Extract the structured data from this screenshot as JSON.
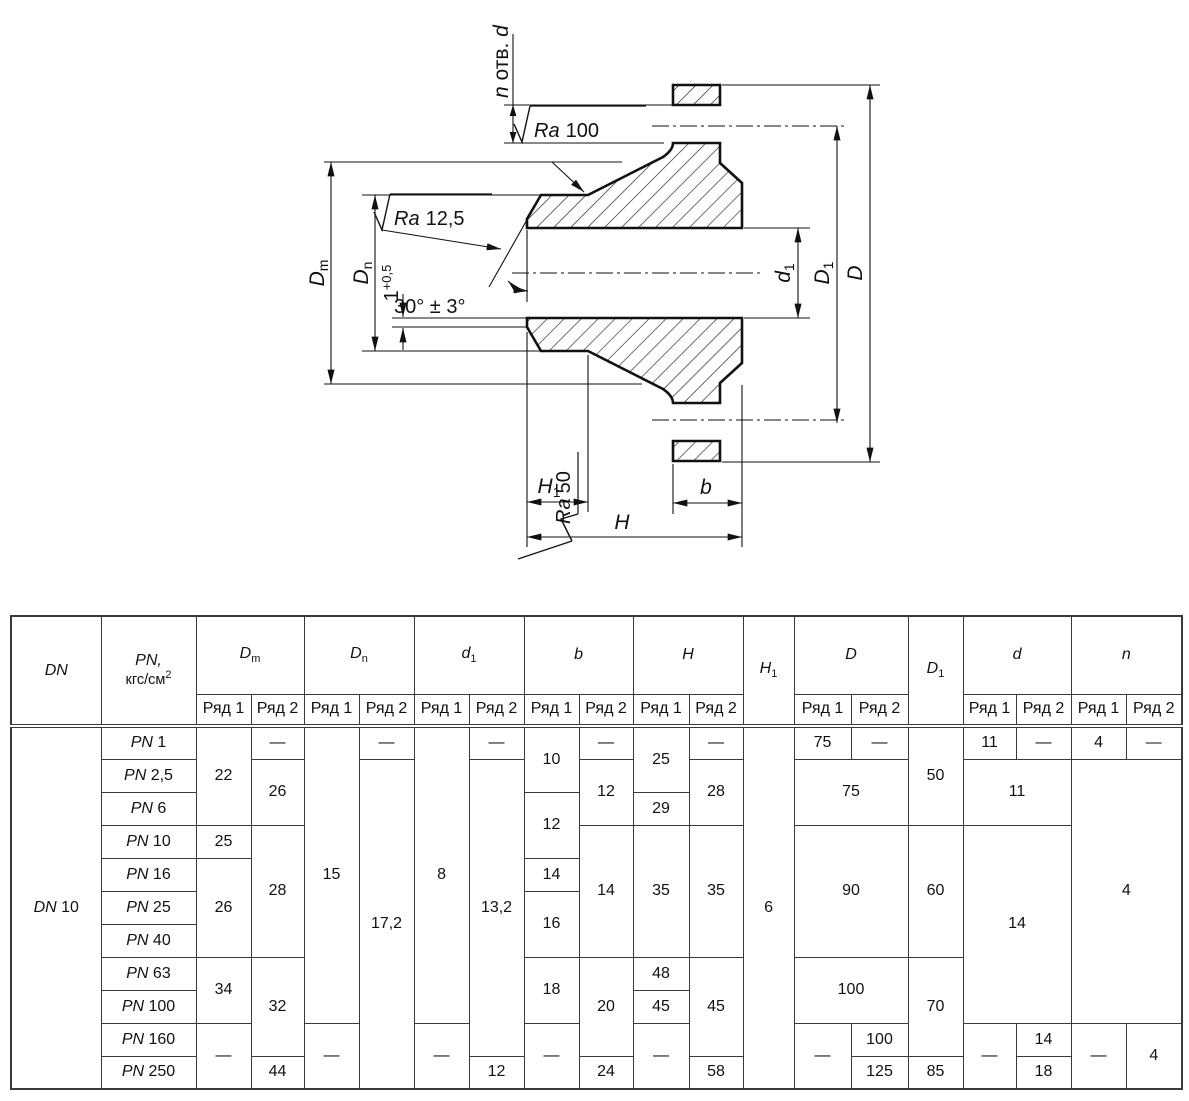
{
  "drawing": {
    "holes_label": {
      "n": "n",
      "mid": " отв. ",
      "d": "d"
    },
    "roughness": {
      "ra100": {
        "ra": "Ra",
        "val": "100"
      },
      "ra125": {
        "ra": "Ra",
        "val": "12,5"
      },
      "ra50": {
        "ra": "Ra",
        "val": "50"
      }
    },
    "angle_note": "30° ± 3°",
    "root_face": {
      "base": "1",
      "sup": "+0,5"
    },
    "dims": {
      "Dm": {
        "base": "D",
        "sub": "m"
      },
      "Dn": {
        "base": "D",
        "sub": "n"
      },
      "d1": {
        "base": "d",
        "sub": "1"
      },
      "D1": {
        "base": "D",
        "sub": "1"
      },
      "D": {
        "base": "D",
        "sub": ""
      },
      "H1": {
        "base": "H",
        "sub": "1"
      },
      "H": {
        "base": "H",
        "sub": ""
      },
      "b": {
        "base": "b",
        "sub": ""
      }
    }
  },
  "table": {
    "dn_header": "DN",
    "pn_header": {
      "line1": "PN,",
      "line2": "кгс/см",
      "sup": "2"
    },
    "row_label_1": "Ряд 1",
    "row_label_2": "Ряд 2",
    "columns": [
      {
        "key": "Dm",
        "base": "D",
        "sub": "m",
        "split": true
      },
      {
        "key": "Dn",
        "base": "D",
        "sub": "n",
        "split": true
      },
      {
        "key": "d1",
        "base": "d",
        "sub": "1",
        "split": true
      },
      {
        "key": "b",
        "base": "b",
        "sub": "",
        "split": true
      },
      {
        "key": "H",
        "base": "H",
        "sub": "",
        "split": true
      },
      {
        "key": "H1",
        "base": "H",
        "sub": "1",
        "split": false
      },
      {
        "key": "D",
        "base": "D",
        "sub": "",
        "split": true
      },
      {
        "key": "D1",
        "base": "D",
        "sub": "1",
        "split": false
      },
      {
        "key": "d",
        "base": "d",
        "sub": "",
        "split": true
      },
      {
        "key": "n",
        "base": "n",
        "sub": "",
        "split": true
      }
    ],
    "dn_value": {
      "prefix": "DN",
      "value": "10",
      "rowspan": 11
    },
    "pn_prefix": "PN",
    "rows": [
      {
        "pn": "1",
        "cells": [
          [
            "dm-r1",
            "22",
            3,
            1
          ],
          [
            "dm-r2",
            "—",
            1,
            1
          ],
          [
            "dn-r1",
            "15",
            9,
            1
          ],
          [
            "dn-r2",
            "—",
            1,
            1
          ],
          [
            "d1-r1",
            "8",
            9,
            1
          ],
          [
            "d1-r2",
            "—",
            1,
            1
          ],
          [
            "b-r1",
            "10",
            2,
            1
          ],
          [
            "b-r2",
            "—",
            1,
            1
          ],
          [
            "h-r1",
            "25",
            2,
            1
          ],
          [
            "h-r2",
            "—",
            1,
            1
          ],
          [
            "h1-col",
            "6",
            11,
            1
          ],
          [
            "d-col-r1",
            "75",
            1,
            1
          ],
          [
            "d-col-r2",
            "—",
            1,
            1
          ],
          [
            "d1-col",
            "50",
            3,
            1
          ],
          [
            "d-small-r1",
            "11",
            1,
            1
          ],
          [
            "d-small-r2",
            "—",
            1,
            1
          ],
          [
            "n-r1",
            "4",
            1,
            1
          ],
          [
            "n-r2",
            "—",
            1,
            1
          ]
        ]
      },
      {
        "pn": "2,5",
        "cells": [
          [
            "dm-r2",
            "26",
            2,
            1
          ],
          [
            "dn-r2",
            "17,2",
            10,
            1
          ],
          [
            "d1-r2",
            "13,2",
            9,
            1
          ],
          [
            "b-r2",
            "12",
            2,
            1
          ],
          [
            "h-r2",
            "28",
            2,
            1
          ],
          [
            "d-col",
            "75",
            2,
            2
          ],
          [
            "d-small",
            "11",
            2,
            2
          ],
          [
            "n",
            "4",
            8,
            2
          ]
        ]
      },
      {
        "pn": "6",
        "cells": [
          [
            "b-r1",
            "12",
            2,
            1
          ],
          [
            "h-r1",
            "29",
            1,
            1
          ]
        ]
      },
      {
        "pn": "10",
        "cells": [
          [
            "dm-r1",
            "25",
            1,
            1
          ],
          [
            "dm-r2",
            "28",
            4,
            1
          ],
          [
            "b-r2",
            "14",
            4,
            1
          ],
          [
            "h-r1",
            "35",
            4,
            1
          ],
          [
            "h-r2",
            "35",
            4,
            1
          ],
          [
            "d-col",
            "90",
            4,
            2
          ],
          [
            "d1-col",
            "60",
            4,
            1
          ],
          [
            "d-small",
            "14",
            6,
            2
          ]
        ]
      },
      {
        "pn": "16",
        "cells": [
          [
            "dm-r1",
            "26",
            3,
            1
          ],
          [
            "b-r1",
            "14",
            1,
            1
          ]
        ]
      },
      {
        "pn": "25",
        "cells": [
          [
            "b-r1",
            "16",
            2,
            1
          ]
        ]
      },
      {
        "pn": "40",
        "cells": []
      },
      {
        "pn": "63",
        "cells": [
          [
            "dm-r1",
            "34",
            2,
            1
          ],
          [
            "dm-r2",
            "32",
            3,
            1
          ],
          [
            "b-r1",
            "18",
            2,
            1
          ],
          [
            "b-r2",
            "20",
            3,
            1
          ],
          [
            "h-r1",
            "48",
            1,
            1
          ],
          [
            "h-r2",
            "45",
            3,
            1
          ],
          [
            "d-col",
            "100",
            2,
            2
          ],
          [
            "d1-col",
            "70",
            3,
            1
          ]
        ]
      },
      {
        "pn": "100",
        "cells": [
          [
            "h-r1",
            "45",
            1,
            1
          ]
        ]
      },
      {
        "pn": "160",
        "cells": [
          [
            "dm-r1",
            "—",
            2,
            1
          ],
          [
            "dn-r1",
            "—",
            2,
            1
          ],
          [
            "d1-r1",
            "—",
            2,
            1
          ],
          [
            "b-r1",
            "—",
            2,
            1
          ],
          [
            "h-r1",
            "—",
            2,
            1
          ],
          [
            "d-col-r1",
            "—",
            2,
            1
          ],
          [
            "d-col-r2",
            "100",
            1,
            1
          ],
          [
            "d-small-r1",
            "—",
            2,
            1
          ],
          [
            "d-small-r2",
            "14",
            1,
            1
          ],
          [
            "n-r1",
            "—",
            2,
            1
          ],
          [
            "n-r2",
            "4",
            2,
            1
          ]
        ]
      },
      {
        "pn": "250",
        "cells": [
          [
            "dm-r2",
            "44",
            1,
            1
          ],
          [
            "d1-r2",
            "12",
            1,
            1
          ],
          [
            "b-r2",
            "24",
            1,
            1
          ],
          [
            "h-r2",
            "58",
            1,
            1
          ],
          [
            "d-col-r2",
            "125",
            1,
            1
          ],
          [
            "d1-col",
            "85",
            1,
            1
          ],
          [
            "d-small-r2",
            "18",
            1,
            1
          ]
        ]
      }
    ]
  }
}
